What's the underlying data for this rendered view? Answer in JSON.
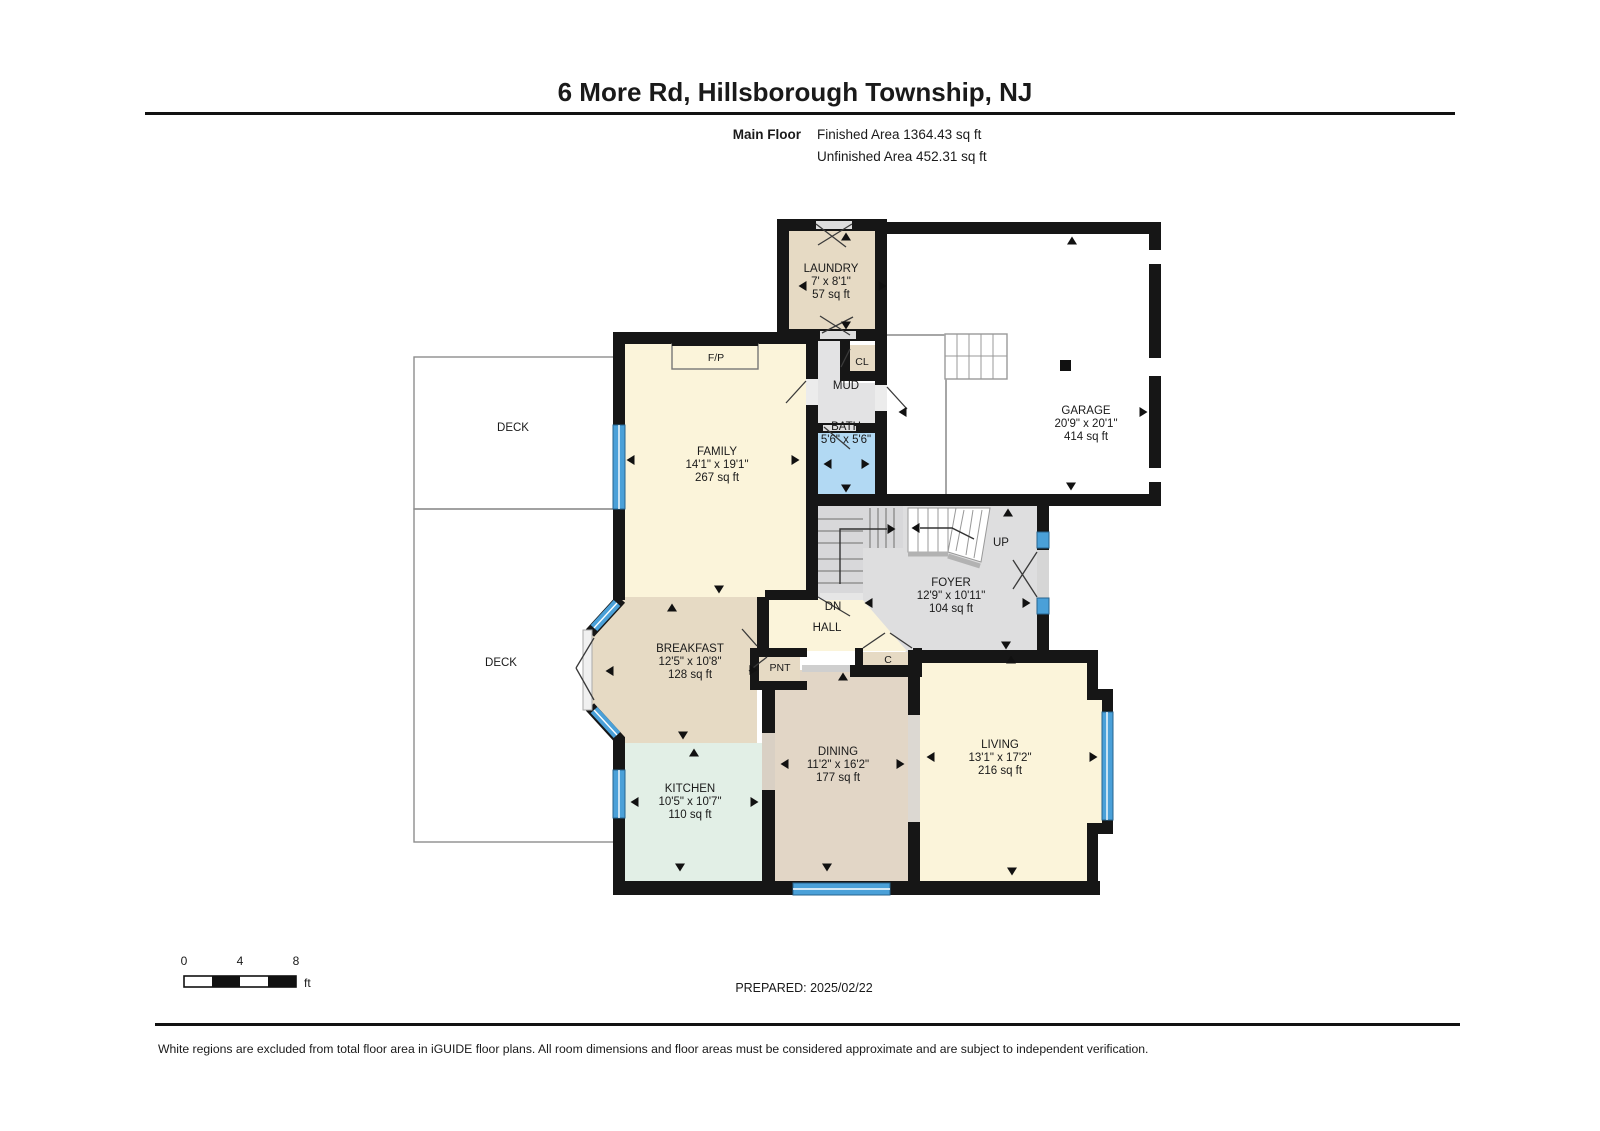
{
  "header": {
    "title": "6 More Rd, Hillsborough Township, NJ",
    "floor_label": "Main Floor",
    "finished_area": "Finished Area 1364.43 sq ft",
    "unfinished_area": "Unfinished Area 452.31 sq ft"
  },
  "rooms": {
    "laundry": {
      "name": "LAUNDRY",
      "dims": "7' x 8'1\"",
      "area": "57 sq ft"
    },
    "garage": {
      "name": "GARAGE",
      "dims": "20'9\" x 20'1\"",
      "area": "414 sq ft"
    },
    "family": {
      "name": "FAMILY",
      "dims": "14'1\" x 19'1\"",
      "area": "267 sq ft"
    },
    "bath": {
      "name": "BATH",
      "dims": "5'6\" x 5'6\""
    },
    "foyer": {
      "name": "FOYER",
      "dims": "12'9\" x 10'11\"",
      "area": "104 sq ft"
    },
    "breakfast": {
      "name": "BREAKFAST",
      "dims": "12'5\" x 10'8\"",
      "area": "128 sq ft"
    },
    "kitchen": {
      "name": "KITCHEN",
      "dims": "10'5\" x 10'7\"",
      "area": "110 sq ft"
    },
    "dining": {
      "name": "DINING",
      "dims": "11'2\" x 16'2\"",
      "area": "177 sq ft"
    },
    "living": {
      "name": "LIVING",
      "dims": "13'1\" x 17'2\"",
      "area": "216 sq ft"
    },
    "mud": {
      "name": "MUD"
    },
    "closet": {
      "name": "CL"
    },
    "hall": {
      "name": "HALL"
    },
    "pantry": {
      "name": "PNT"
    },
    "coat": {
      "name": "C"
    },
    "fireplace": {
      "name": "F/P"
    },
    "deck_upper": {
      "name": "DECK"
    },
    "deck_lower": {
      "name": "DECK"
    },
    "stairs_up": {
      "name": "UP"
    },
    "stairs_down": {
      "name": "DN"
    }
  },
  "scale_bar": {
    "tick0": "0",
    "tick4": "4",
    "tick8": "8",
    "unit": "ft"
  },
  "footer": {
    "prepared": "PREPARED: 2025/02/22",
    "disclaimer": "White regions are excluded from total floor area in iGUIDE floor plans. All room dimensions and floor areas must be considered approximate and are subject to independent verification."
  },
  "colors": {
    "wall": "#161616",
    "room_cream": "#fbf4da",
    "room_tan": "#e6dac4",
    "room_mint": "#e2efe6",
    "room_gray": "#dededf",
    "room_blue": "#b2d9f3",
    "window_blue": "#4aa0d8"
  }
}
